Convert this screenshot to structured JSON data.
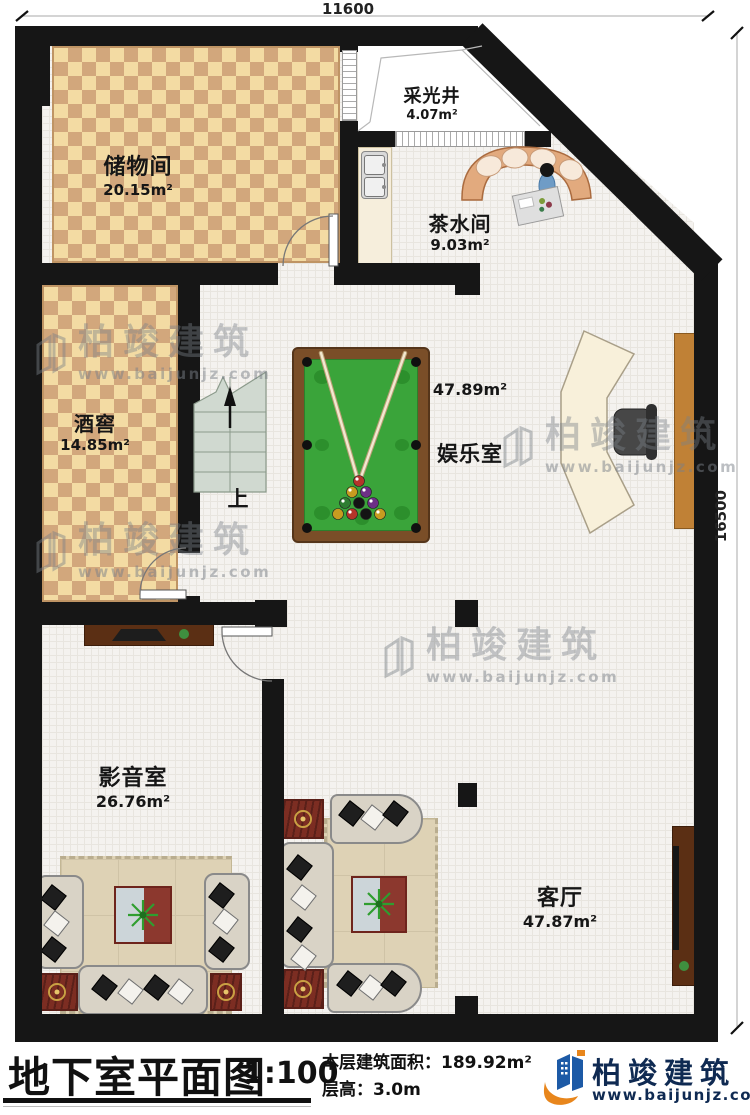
{
  "dimensions": {
    "top": "11600",
    "right": "16500"
  },
  "rooms": [
    {
      "id": "storage",
      "name": "储物间",
      "area": "20.15m²"
    },
    {
      "id": "lightwell",
      "name": "采光井",
      "area": "4.07m²"
    },
    {
      "id": "tea",
      "name": "茶水间",
      "area": "9.03m²"
    },
    {
      "id": "wine",
      "name": "酒窖",
      "area": "14.85m²"
    },
    {
      "id": "game",
      "name": "娱乐室",
      "area": "47.89m²"
    },
    {
      "id": "media",
      "name": "影音室",
      "area": "26.76m²"
    },
    {
      "id": "living",
      "name": "客厅",
      "area": "47.87m²"
    }
  ],
  "stairs": {
    "up_label": "上"
  },
  "watermark": {
    "brand": "柏竣建筑",
    "url": "www.baijunjz.com"
  },
  "titlebar": {
    "title": "地下室平面图",
    "scale": "1:100",
    "area_label": "本层建筑面积：",
    "area_value": "189.92m²",
    "floor_height_label": "层高：",
    "floor_height_value": "3.0m"
  },
  "logo": {
    "brand": "柏竣建筑",
    "url": "www.baijunjz.com"
  },
  "colors": {
    "wall": "#161616",
    "felt_green": "#3aa43a",
    "accent_blue": "#1d5aa6",
    "accent_orange": "#e8861c"
  }
}
